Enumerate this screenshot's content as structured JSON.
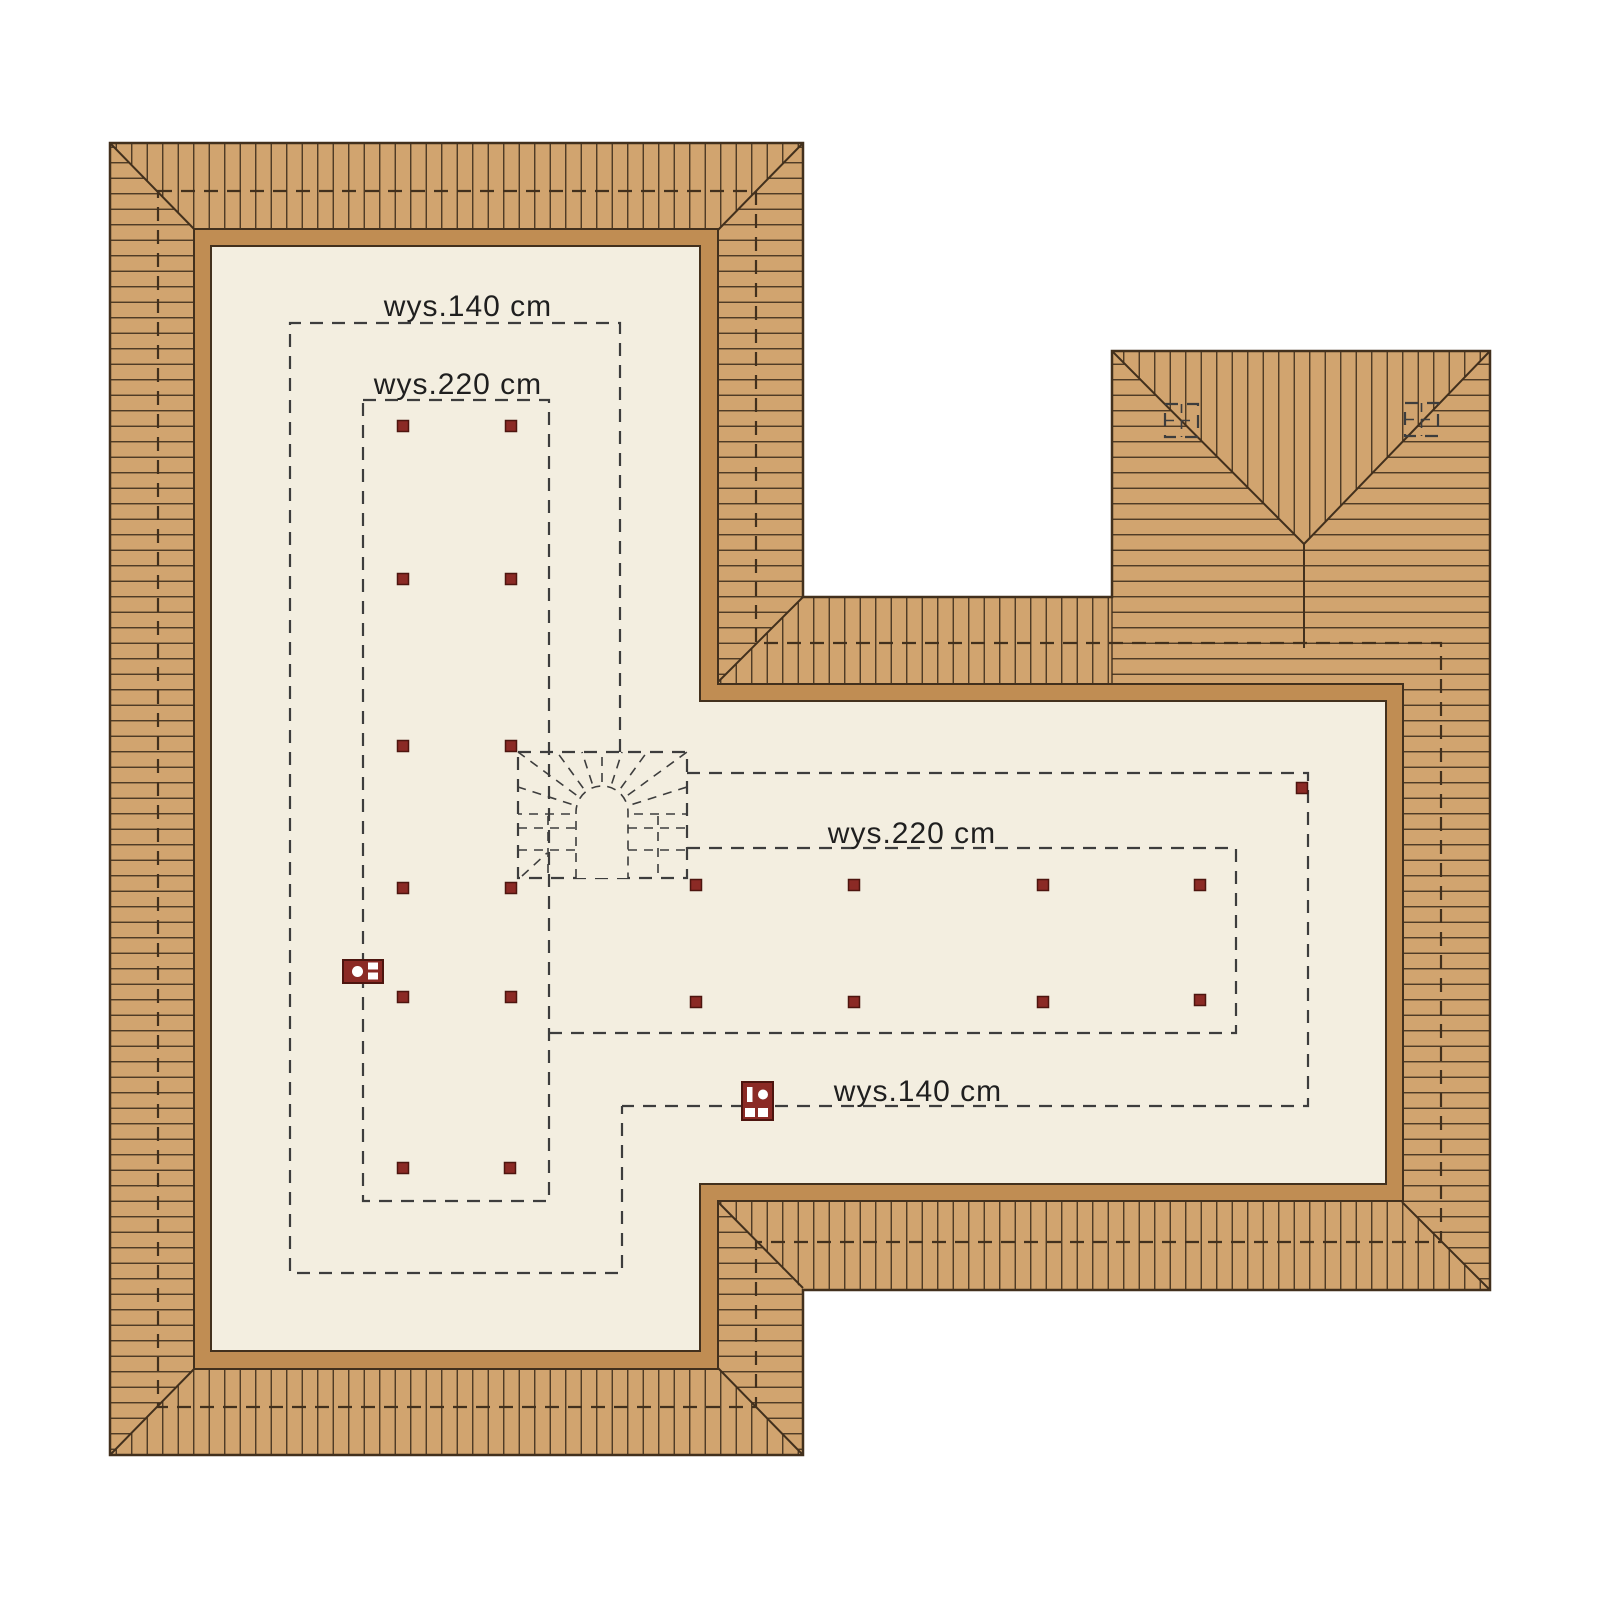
{
  "page": {
    "background": "#ffffff",
    "title": "attic floor plan with roof height contours"
  },
  "plan": {
    "labels": [
      {
        "id": "label-140-left",
        "text": "wys.140 cm"
      },
      {
        "id": "label-220-left",
        "text": "wys.220 cm"
      },
      {
        "id": "label-220-wing",
        "text": "wys.220 cm"
      },
      {
        "id": "label-140-wing",
        "text": "wys.140 cm"
      }
    ],
    "colors": {
      "roof": "#d1a46f",
      "wall": "#c08d53",
      "floor": "#f3eee0",
      "line": "#42301d",
      "dash": "#3d3d3d",
      "post": "#8b2a25",
      "post_border": "#4d150f",
      "cutout": "#ffffff",
      "text": "#1f1f1f"
    },
    "height_contours": [
      {
        "name": "contour-140-left",
        "closed": false,
        "points": [
          [
            620,
            752
          ],
          [
            620,
            323
          ],
          [
            290,
            323
          ],
          [
            290,
            1273
          ],
          [
            622,
            1273
          ],
          [
            622,
            1106
          ]
        ]
      },
      {
        "name": "contour-140-wing",
        "closed": false,
        "points": [
          [
            687,
            773
          ],
          [
            1308,
            773
          ],
          [
            1308,
            1106
          ],
          [
            622,
            1106
          ]
        ]
      },
      {
        "name": "contour-220-left",
        "closed": true,
        "points": [
          [
            363,
            400
          ],
          [
            549,
            400
          ],
          [
            549,
            1201
          ],
          [
            363,
            1201
          ]
        ]
      },
      {
        "name": "contour-220-wing",
        "closed": false,
        "points": [
          [
            549,
            1033
          ],
          [
            1236,
            1033
          ],
          [
            1236,
            848
          ],
          [
            687,
            848
          ]
        ]
      },
      {
        "name": "stair-outline",
        "closed": true,
        "points": [
          [
            518,
            752
          ],
          [
            687,
            752
          ],
          [
            687,
            878
          ],
          [
            518,
            878
          ]
        ]
      }
    ],
    "eave_outline": {
      "closed": true,
      "points": [
        [
          158,
          191
        ],
        [
          756,
          191
        ],
        [
          756,
          643
        ],
        [
          1441,
          643
        ],
        [
          1441,
          1242
        ],
        [
          756,
          1242
        ],
        [
          756,
          1407
        ],
        [
          158,
          1407
        ]
      ]
    },
    "roof_windows": [
      {
        "x": 1165,
        "y": 404,
        "w": 33,
        "h": 33
      },
      {
        "x": 1405,
        "y": 403,
        "w": 33,
        "h": 33
      }
    ],
    "posts": [
      [
        403,
        426
      ],
      [
        511,
        426
      ],
      [
        403,
        579
      ],
      [
        511,
        579
      ],
      [
        403,
        746
      ],
      [
        511,
        746
      ],
      [
        403,
        888
      ],
      [
        511,
        888
      ],
      [
        403,
        997
      ],
      [
        511,
        997
      ],
      [
        403,
        1168
      ],
      [
        510,
        1168
      ],
      [
        696,
        885
      ],
      [
        854,
        885
      ],
      [
        1043,
        885
      ],
      [
        1200,
        885
      ],
      [
        696,
        1002
      ],
      [
        854,
        1002
      ],
      [
        1043,
        1002
      ],
      [
        1200,
        1000
      ],
      [
        1302,
        788
      ]
    ],
    "post_size": 11
  }
}
